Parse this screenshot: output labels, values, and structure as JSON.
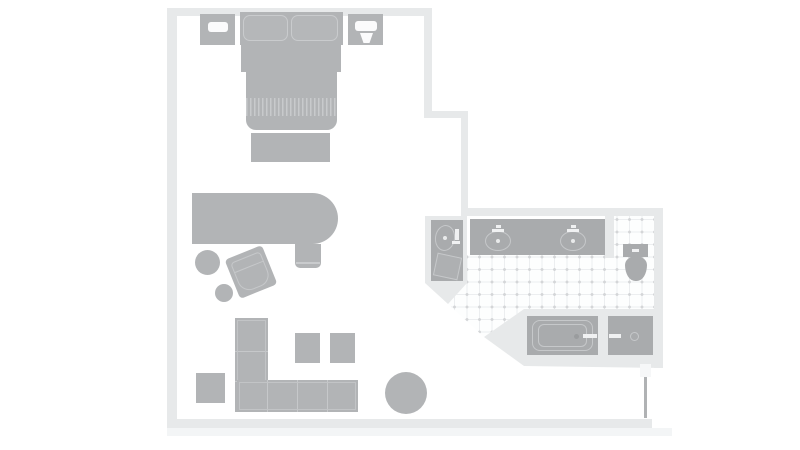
{
  "colors": {
    "wall": "#e7e9ea",
    "wallShadow": "#f3f5f6",
    "furniture": "#b2b4b6",
    "furnitureLight": "#c9cbcd",
    "fixture": "#a9abad",
    "fixtureOutline": "#c6c8ca",
    "lamp": "#fbfbfc",
    "whiteDetail": "#f0f1f2",
    "doorLeaf": "#b0b2b4",
    "hinge": "#f6f7f8",
    "drain": "#e9eaeb",
    "tubDrain": "#9a9c9e"
  },
  "plan": {
    "name": "hotel-room-floor-plan",
    "items": [
      {
        "name": "wall-bottom-shadow",
        "x": 167,
        "y": 428,
        "w": 505,
        "h": 8,
        "fill": "wallShadow"
      },
      {
        "name": "wall-top",
        "x": 167,
        "y": 8,
        "w": 265,
        "h": 8,
        "fill": "wall"
      },
      {
        "name": "wall-left",
        "x": 167,
        "y": 8,
        "w": 10,
        "h": 420,
        "fill": "wall"
      },
      {
        "name": "wall-bottom",
        "x": 167,
        "y": 419,
        "w": 485,
        "h": 9,
        "fill": "wall"
      },
      {
        "name": "wall-bedroom-right-upper",
        "x": 424,
        "y": 8,
        "w": 8,
        "h": 110,
        "fill": "wall"
      },
      {
        "name": "wall-jut",
        "x": 424,
        "y": 111,
        "w": 44,
        "h": 7,
        "fill": "wall"
      },
      {
        "name": "wall-bedroom-right-lower",
        "x": 461,
        "y": 111,
        "w": 7,
        "h": 105,
        "fill": "wall"
      },
      {
        "name": "wall-bathroom-top",
        "x": 461,
        "y": 208,
        "w": 202,
        "h": 8,
        "fill": "wall"
      },
      {
        "name": "wall-bathroom-right",
        "x": 654,
        "y": 216,
        "w": 9,
        "h": 152,
        "fill": "wall"
      },
      {
        "name": "bathroom-tile-floor",
        "x": 448,
        "y": 216,
        "w": 206,
        "h": 121,
        "cls": "tile",
        "clip": "polygon(19px 39px,157px 39px,157px 0px,206px 0px,206px 93px,76px 93px,36px 121px,0px 88px,19px 67px)"
      },
      {
        "name": "wall-vanity-nook",
        "x": 425,
        "y": 216,
        "w": 42,
        "h": 88,
        "fill": "wall",
        "clip": "polygon(0px 0px,42px 0px,42px 67px,23px 88px,0px 67px)"
      },
      {
        "name": "wall-toilet-divider",
        "x": 605,
        "y": 216,
        "w": 9,
        "h": 42,
        "fill": "wall"
      },
      {
        "name": "wall-tub-surround",
        "x": 484,
        "y": 309,
        "w": 179,
        "h": 59,
        "fill": "wall",
        "clip": "polygon(0px 28px,40px 0px,179px 0px,179px 59px,40px 57px)"
      },
      {
        "name": "vanity-counter",
        "x": 470,
        "y": 219,
        "w": 135,
        "h": 36,
        "fill": "fixture"
      },
      {
        "name": "sink-left",
        "x": 485,
        "y": 231,
        "w": 26,
        "h": 20,
        "radius": "50%",
        "border": {
          "w": 1.2,
          "c": "fixtureOutline"
        }
      },
      {
        "name": "sink-right",
        "x": 560,
        "y": 231,
        "w": 26,
        "h": 20,
        "radius": "50%",
        "border": {
          "w": 1.2,
          "c": "fixtureOutline"
        }
      },
      {
        "name": "sink-left-drain",
        "x": 496,
        "y": 239,
        "w": 4,
        "h": 4,
        "radius": "50%",
        "fill": "drain"
      },
      {
        "name": "sink-right-drain",
        "x": 571,
        "y": 239,
        "w": 4,
        "h": 4,
        "radius": "50%",
        "fill": "drain"
      },
      {
        "name": "faucet-left-icon",
        "x": 492,
        "y": 229,
        "w": 12,
        "h": 3,
        "fill": "whiteDetail"
      },
      {
        "name": "faucet-left-spout-icon",
        "x": 496,
        "y": 225,
        "w": 5,
        "h": 3,
        "fill": "whiteDetail"
      },
      {
        "name": "faucet-right-icon",
        "x": 567,
        "y": 229,
        "w": 12,
        "h": 3,
        "fill": "whiteDetail"
      },
      {
        "name": "faucet-right-spout-icon",
        "x": 571,
        "y": 225,
        "w": 5,
        "h": 3,
        "fill": "whiteDetail"
      },
      {
        "name": "nook-vanity",
        "x": 431,
        "y": 220,
        "w": 32,
        "h": 61,
        "fill": "fixture"
      },
      {
        "name": "nook-sink",
        "x": 435,
        "y": 225,
        "w": 20,
        "h": 26,
        "radius": "50%",
        "border": {
          "w": 1.2,
          "c": "fixtureOutline"
        },
        "rotate": 8
      },
      {
        "name": "nook-sink-drain",
        "x": 443,
        "y": 236,
        "w": 4,
        "h": 4,
        "radius": "50%",
        "fill": "drain"
      },
      {
        "name": "nook-faucet-icon",
        "x": 455,
        "y": 229,
        "w": 4,
        "h": 11,
        "fill": "whiteDetail"
      },
      {
        "name": "nook-faucet-handle-icon",
        "x": 452,
        "y": 241,
        "w": 8,
        "h": 3,
        "fill": "whiteDetail"
      },
      {
        "name": "nook-hamper",
        "x": 435,
        "y": 255,
        "w": 25,
        "h": 23,
        "rotate": 12,
        "fill": "#aeb0b2",
        "border": {
          "w": 1.3,
          "c": "fixtureOutline"
        }
      },
      {
        "name": "toilet-tank",
        "x": 623,
        "y": 244,
        "w": 25,
        "h": 13,
        "fill": "fixture"
      },
      {
        "name": "toilet-flush-button",
        "x": 632,
        "y": 249,
        "w": 7,
        "h": 2.5,
        "fill": "whiteDetail"
      },
      {
        "name": "toilet-bowl",
        "x": 625,
        "y": 256,
        "w": 22,
        "h": 25,
        "fill": "fixture",
        "radius": "50% 50% 46% 46% / 36% 36% 64% 64%"
      },
      {
        "name": "bathtub",
        "x": 527,
        "y": 316,
        "w": 71,
        "h": 39,
        "fill": "fixture"
      },
      {
        "name": "bathtub-rim",
        "x": 532,
        "y": 320,
        "w": 61,
        "h": 31,
        "radius": "8px",
        "border": {
          "w": 1.2,
          "c": "fixtureOutline"
        }
      },
      {
        "name": "bathtub-basin",
        "x": 538,
        "y": 324,
        "w": 49,
        "h": 23,
        "radius": "6px",
        "border": {
          "w": 1.2,
          "c": "fixtureOutline"
        }
      },
      {
        "name": "bathtub-drain",
        "x": 574,
        "y": 334,
        "w": 5,
        "h": 5,
        "radius": "50%",
        "fill": "tubDrain"
      },
      {
        "name": "bathtub-faucet-icon",
        "x": 583,
        "y": 334,
        "w": 14,
        "h": 4,
        "fill": "whiteDetail"
      },
      {
        "name": "shower-pan",
        "x": 608,
        "y": 316,
        "w": 45,
        "h": 39,
        "fill": "fixture"
      },
      {
        "name": "shower-faucet-icon",
        "x": 609,
        "y": 334,
        "w": 12,
        "h": 4,
        "fill": "whiteDetail"
      },
      {
        "name": "shower-drain",
        "x": 630,
        "y": 332,
        "w": 9,
        "h": 9,
        "radius": "50%",
        "border": {
          "w": 1.2,
          "c": "fixtureOutline"
        }
      },
      {
        "name": "entry-door-hinge",
        "x": 640,
        "y": 364,
        "w": 11,
        "h": 13,
        "fill": "hinge"
      },
      {
        "name": "entry-door-leaf",
        "x": 644,
        "y": 377,
        "w": 2.5,
        "h": 41,
        "fill": "doorLeaf"
      },
      {
        "name": "nightstand-left",
        "x": 200,
        "y": 14,
        "w": 35,
        "h": 31,
        "fill": "furniture"
      },
      {
        "name": "nightstand-left-lamp-icon",
        "x": 208,
        "y": 22,
        "w": 20,
        "h": 10,
        "radius": "3px",
        "fill": "lamp"
      },
      {
        "name": "nightstand-right",
        "x": 348,
        "y": 14,
        "w": 35,
        "h": 31,
        "fill": "furniture"
      },
      {
        "name": "nightstand-right-lamp-icon",
        "x": 355,
        "y": 21,
        "w": 22,
        "h": 10,
        "radius": "3px",
        "fill": "lamp"
      },
      {
        "name": "nightstand-right-cup-icon",
        "x": 360,
        "y": 32,
        "w": 13,
        "h": 11,
        "fill": "lamp",
        "clip": "polygon(0px 1px,13px 1px,9.5px 11px,3.5px 11px)"
      },
      {
        "name": "bed-headboard",
        "x": 240,
        "y": 12,
        "w": 103,
        "h": 33,
        "fill": "furniture"
      },
      {
        "name": "pillow-left",
        "x": 243,
        "y": 15,
        "w": 45,
        "h": 26,
        "radius": "7px",
        "fill": "#b5b7b9",
        "border": {
          "w": 1.4,
          "c": "furnitureLight"
        }
      },
      {
        "name": "pillow-right",
        "x": 291,
        "y": 15,
        "w": 47,
        "h": 26,
        "radius": "7px",
        "fill": "#b5b7b9",
        "border": {
          "w": 1.4,
          "c": "furnitureLight"
        }
      },
      {
        "name": "bed-upper",
        "x": 241,
        "y": 45,
        "w": 100,
        "h": 27,
        "fill": "furniture"
      },
      {
        "name": "bed-lower",
        "x": 246,
        "y": 72,
        "w": 91,
        "h": 58,
        "radius": "0 0 10px 10px",
        "fill": "furniture"
      },
      {
        "name": "bed-blanket-stripes",
        "x": 246,
        "y": 98,
        "w": 91,
        "h": 18,
        "cls": "stripes"
      },
      {
        "name": "bed-bench",
        "x": 251,
        "y": 133,
        "w": 79,
        "h": 29,
        "fill": "furniture"
      },
      {
        "name": "desk",
        "x": 192,
        "y": 193,
        "w": 146,
        "h": 51,
        "radius": "0 26px 26px 0",
        "fill": "furniture"
      },
      {
        "name": "desk-chair",
        "x": 295,
        "y": 244,
        "w": 26,
        "h": 24,
        "radius": "0 0 5px 5px",
        "fill": "furniture"
      },
      {
        "name": "desk-chair-seam",
        "x": 296,
        "y": 262,
        "w": 24,
        "h": 1.5,
        "fill": "furnitureLight"
      },
      {
        "name": "stool",
        "x": 195,
        "y": 250,
        "w": 25,
        "h": 25,
        "radius": "50%",
        "fill": "furniture"
      },
      {
        "name": "floor-cushion",
        "x": 215,
        "y": 284,
        "w": 18,
        "h": 18,
        "radius": "50%",
        "fill": "furniture"
      },
      {
        "name": "armchair",
        "x": 231,
        "y": 251,
        "w": 40,
        "h": 42,
        "rotate": -22,
        "radius": "4px",
        "fill": "furniture",
        "cls": "armchair"
      },
      {
        "name": "sofa-chaise",
        "x": 235,
        "y": 318,
        "w": 33,
        "h": 94,
        "fill": "furniture",
        "cls": "sofa-v"
      },
      {
        "name": "sofa-base",
        "x": 237,
        "y": 380,
        "w": 121,
        "h": 32,
        "fill": "furniture",
        "cls": "sofa-h"
      },
      {
        "name": "ottoman-left",
        "x": 295,
        "y": 333,
        "w": 25,
        "h": 30,
        "fill": "furniture"
      },
      {
        "name": "ottoman-right",
        "x": 330,
        "y": 333,
        "w": 25,
        "h": 30,
        "fill": "furniture"
      },
      {
        "name": "side-table",
        "x": 196,
        "y": 373,
        "w": 29,
        "h": 30,
        "fill": "furniture"
      },
      {
        "name": "round-table",
        "x": 385,
        "y": 372,
        "w": 42,
        "h": 42,
        "radius": "50%",
        "fill": "furniture"
      }
    ]
  }
}
